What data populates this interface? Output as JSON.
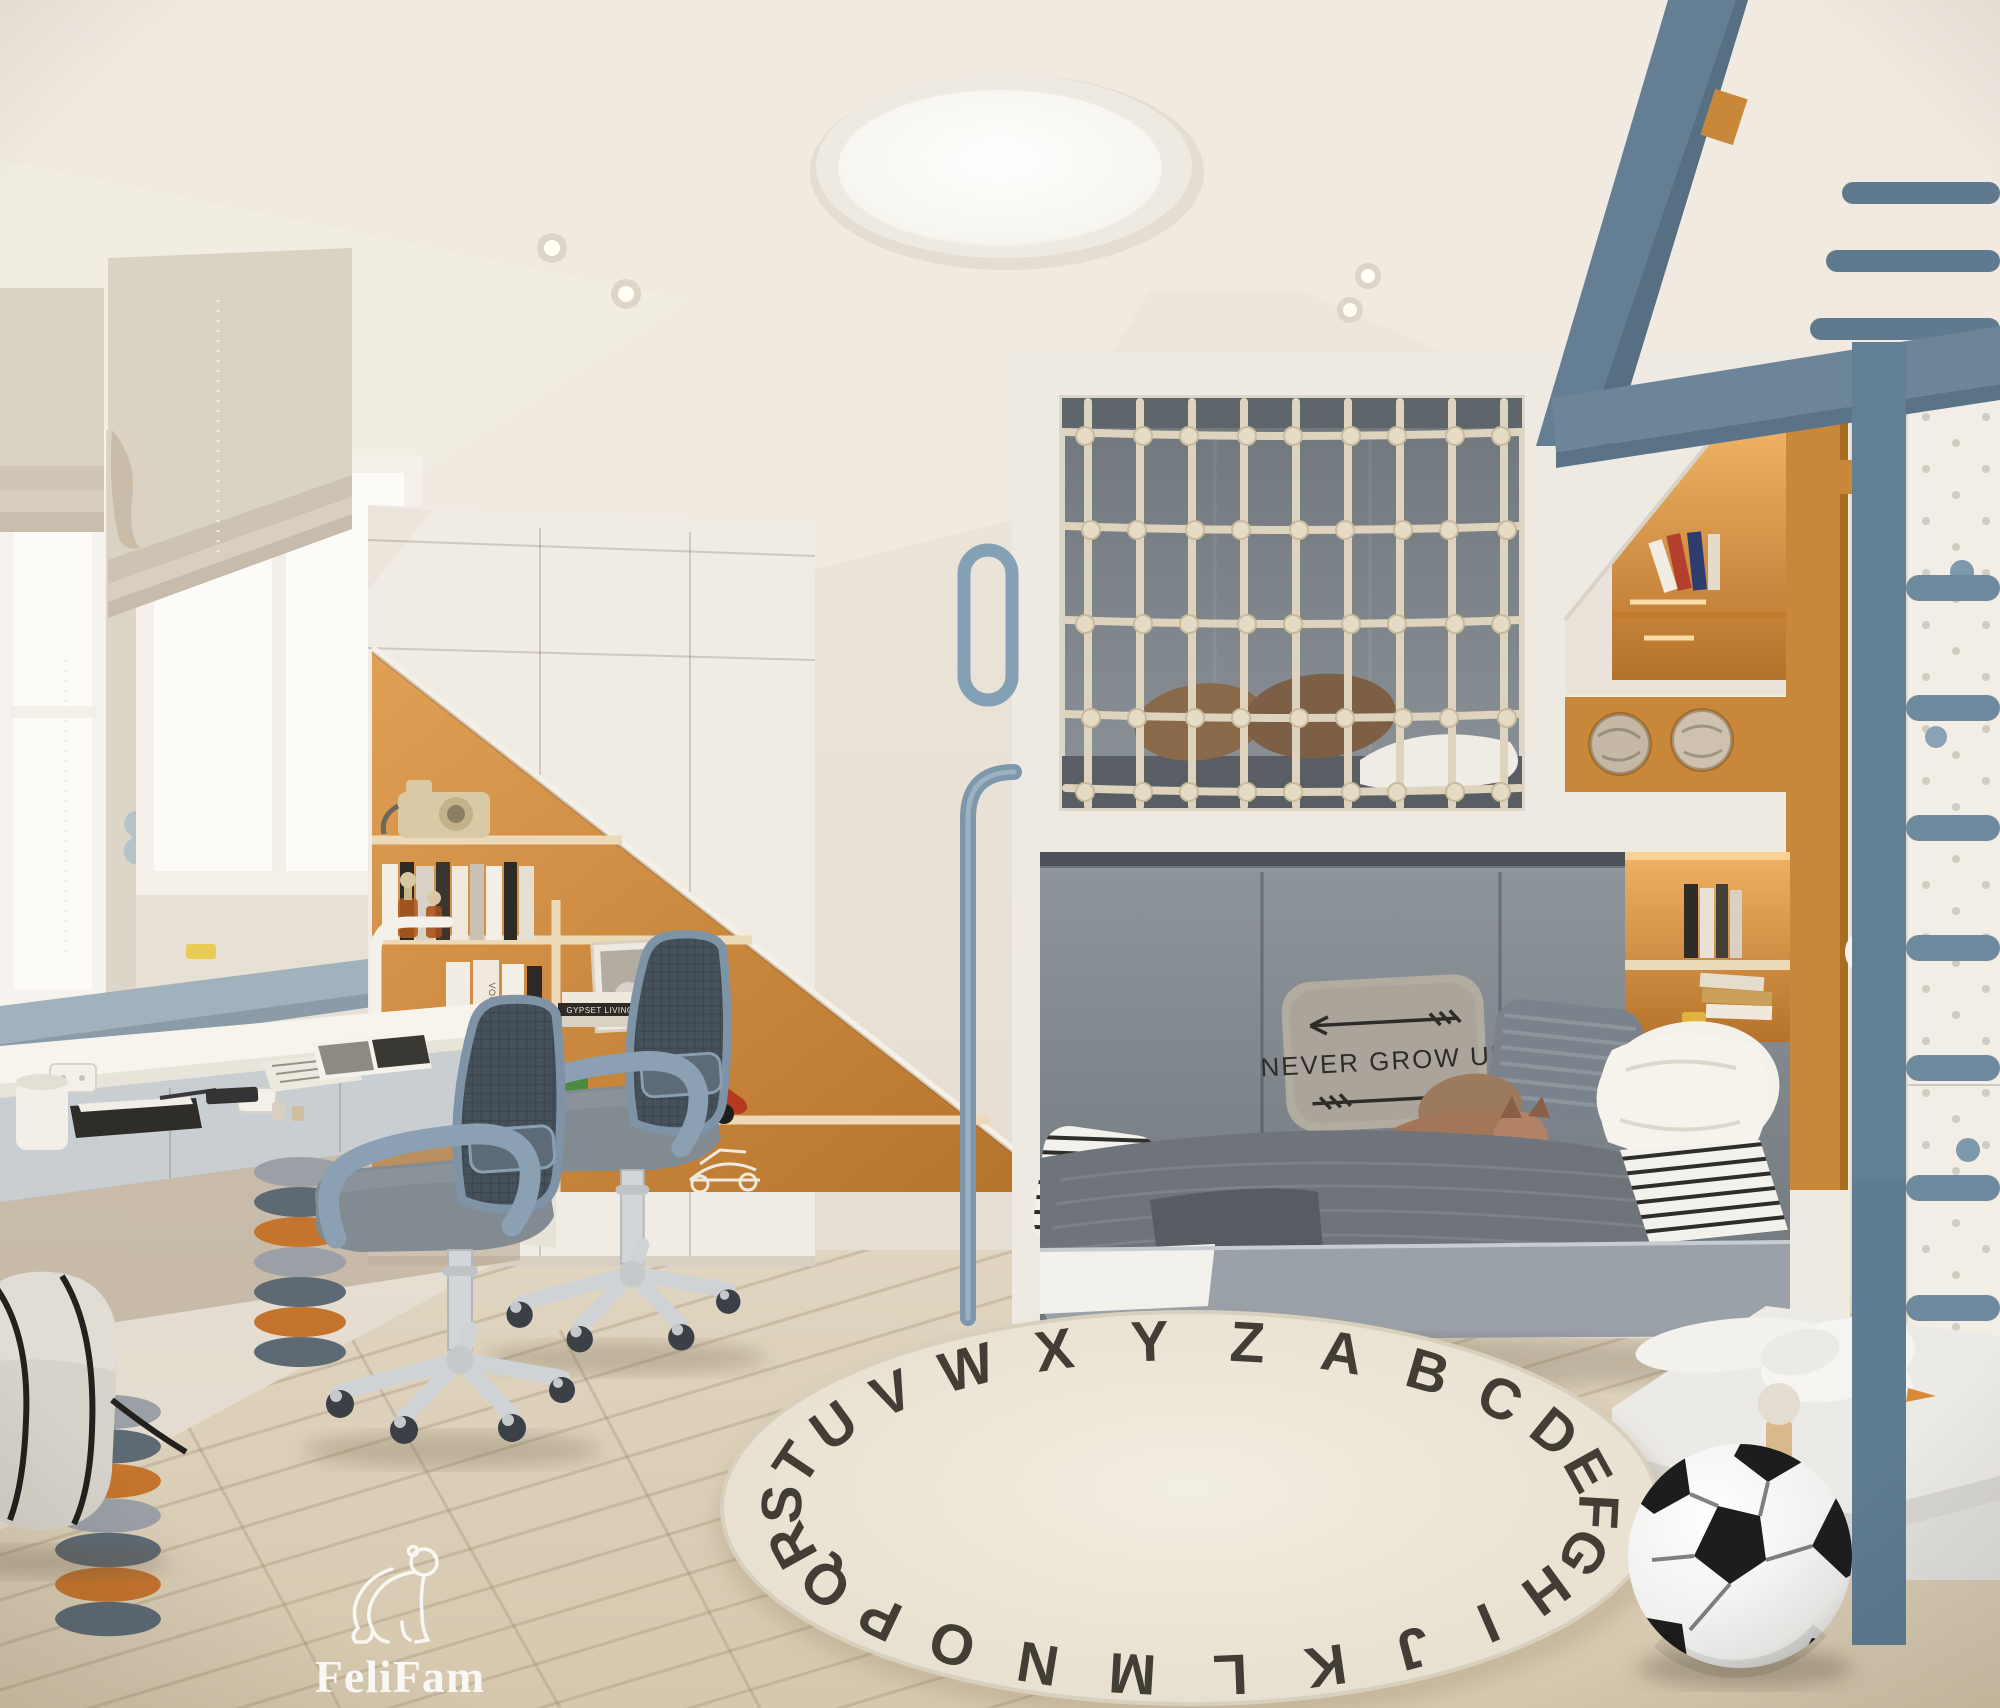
{
  "scene": {
    "type": "interior-render",
    "room": "kids-bedroom-with-loft-bed"
  },
  "watermark": {
    "brand": "FeliFam",
    "icon": "polar-bear-outline-icon"
  },
  "bed": {
    "pillow_text": "NEVER GROW UP"
  },
  "rug": {
    "letters": "ABCDEFGHIJKLMNOPQRSTUVWXYZ",
    "cx": 1190,
    "cy": 1508,
    "rx": 404,
    "ry": 163,
    "start_deg": -68,
    "font_size": 57
  },
  "shelf": {
    "book_titles": [
      "GYPSET LIVING",
      "VOGUE",
      "KATE MOSS"
    ]
  },
  "net": {
    "x0": 1088,
    "x1": 1504,
    "cols": 9,
    "y_top": 402,
    "y_bottom": 806,
    "rows": [
      432,
      526,
      620,
      714,
      788
    ]
  },
  "pegboard": {
    "x_cols": [
      1926,
      1956,
      1986
    ],
    "y0": 365,
    "y1": 1480,
    "step": 52
  },
  "planks": {
    "slope": -0.3,
    "spacing": 150,
    "count": 22
  },
  "palette": {
    "wall": "#e8e1d6",
    "ceiling": "#f0eae1",
    "floor": "#ddd0b9",
    "accent_orange": "#c9873a",
    "accent_blue": "#7b95a9",
    "furniture_white": "#f0ebe2",
    "bed_gray": "#878e94",
    "rope": "#ded3bc",
    "rug": "#efe8da",
    "letters": "#2b2820",
    "metal_blue": "#6a8599"
  }
}
